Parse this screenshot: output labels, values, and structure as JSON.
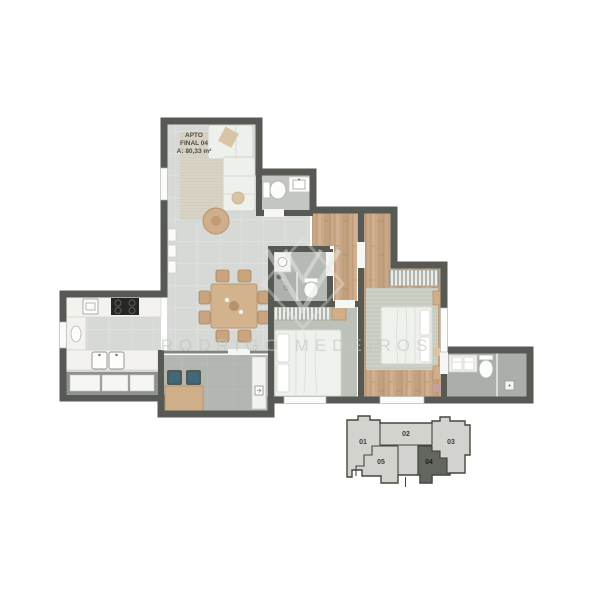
{
  "document": {
    "type": "apartment-floor-plan"
  },
  "unit_label": {
    "line1": "APTO",
    "line2": "FINAL 04",
    "line3": "A: 80,33 m²"
  },
  "watermark": {
    "text": "RODRIGO MEDEIROS"
  },
  "keyplan": {
    "units": [
      {
        "label": "01",
        "highlighted": false
      },
      {
        "label": "02",
        "highlighted": false
      },
      {
        "label": "03",
        "highlighted": false
      },
      {
        "label": "04",
        "highlighted": true
      },
      {
        "label": "05",
        "highlighted": false
      }
    ],
    "highlighted_unit": "04"
  },
  "colors": {
    "wall": "#575954",
    "tile_floor": "#d6d9d5",
    "wood_floor": "#c9a887",
    "carpet": "#bcc1b9",
    "bath_floor": "#b6bab4",
    "balcony_floor": "#b2b6b0",
    "counter": "#f3f2ef",
    "cushion_accent": "#40687a",
    "furniture_wood": "#cfae8a",
    "keyplan_light": "#d2d3cf",
    "keyplan_dark": "#63655f"
  },
  "icons": {
    "cooktop-icon": "black square, 4 burner rings",
    "sink-icon": "white basin rectangle + faucet dot",
    "toilet-icon": "tank bar + oval bowl",
    "shower-icon": "glass line + drain square",
    "bed-icon": "mattress with pillows",
    "sofa-icon": "white L-shaped sofa",
    "wardrobe-icon": "striped hanging rack"
  }
}
